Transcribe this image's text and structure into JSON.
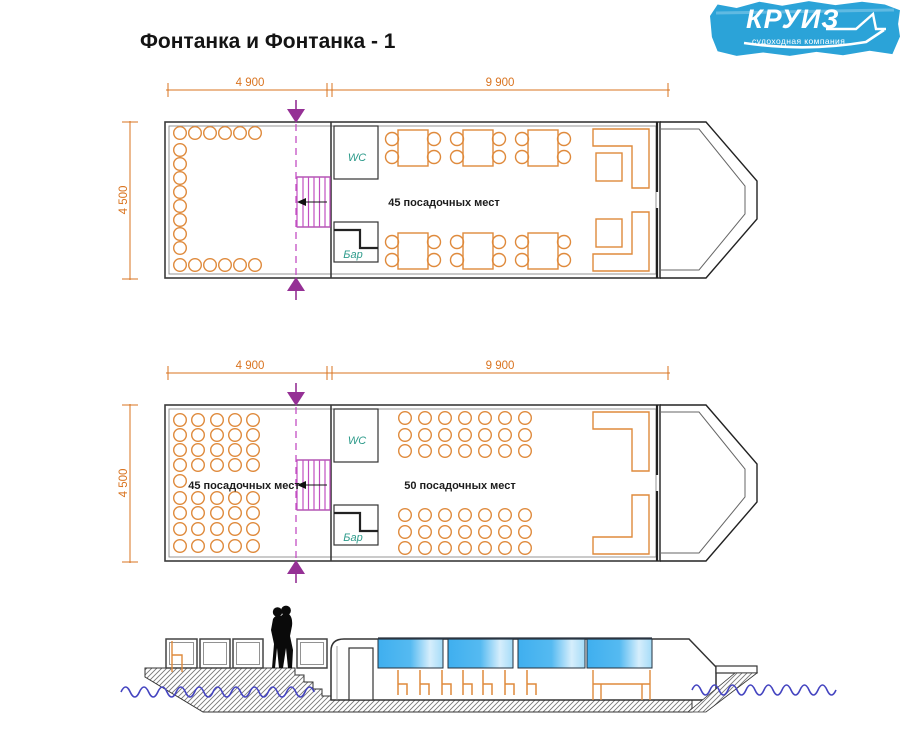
{
  "logo": {
    "brand": "КРУИЗ",
    "tagline": "судоходная компания"
  },
  "page": {
    "title": "Фонтанка и Фонтанка - 1"
  },
  "deck1": {
    "dim_left": "4 900",
    "dim_right": "9 900",
    "dim_side": "4 500",
    "wc": "WC",
    "bar": "Бар",
    "seats": "45 посадочных мест"
  },
  "deck2": {
    "dim_left": "4 900",
    "dim_right": "9 900",
    "dim_side": "4 500",
    "wc": "WC",
    "bar": "Бар",
    "seats_left": "45 посадочных мест",
    "seats_right": "50 посадочных мест"
  },
  "colors": {
    "furniture_orange": "#DF8A3C",
    "dimension_orange": "#D9731F",
    "stairs_magenta": "#C24FC2",
    "arrow_purple": "#953095",
    "room_label_teal": "#2E9B8B",
    "window_blue": "#45B2EE",
    "water_blue": "#4444C0",
    "logo_blue": "#2BA3D8"
  }
}
